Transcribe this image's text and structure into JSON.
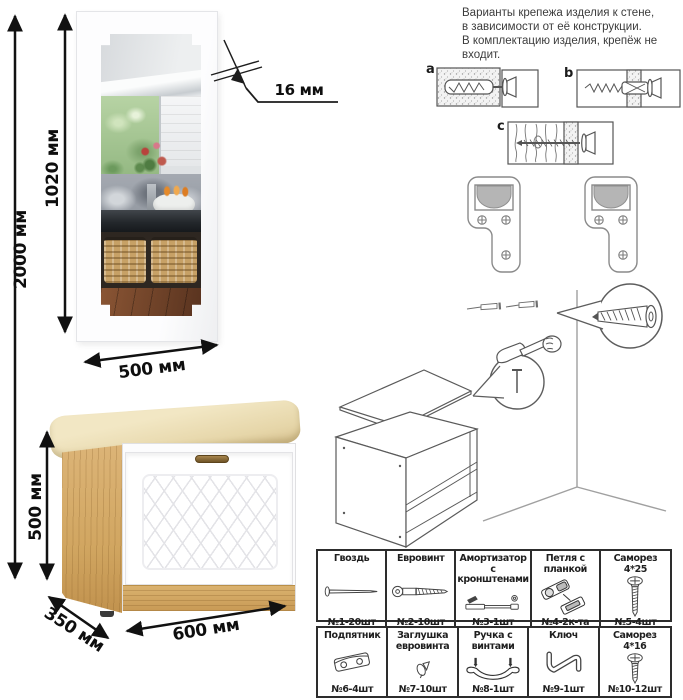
{
  "note": {
    "text": "Варианты крепежа изделия к стене,\nв зависимости от её конструкции.\nВ комплектацию изделия, крепёж не\nвходит."
  },
  "dimensions": {
    "total_height": "2000 мм",
    "mirror_height": "1020 мм",
    "mirror_width": "500 мм",
    "panel_thickness": "16 мм",
    "cabinet_height": "500 мм",
    "cabinet_depth": "350 мм",
    "cabinet_width": "600 мм"
  },
  "wall_mount_options": {
    "a": "a",
    "b": "b",
    "c": "c"
  },
  "hardware_table": {
    "items": [
      {
        "name": "Гвоздь",
        "count": "№1-20шт"
      },
      {
        "name": "Евровинт",
        "count": "№2-10шт"
      },
      {
        "name": "Амортизатор с кронштенами",
        "count": "№3-1шт"
      },
      {
        "name": "Петля с планкой",
        "count": "№4-2к-та"
      },
      {
        "name": "Саморез 4*25",
        "count": "№5-4шт"
      },
      {
        "name": "Подпятник",
        "count": "№6-4шт"
      },
      {
        "name": "Заглушка евровинта",
        "count": "№7-10шт"
      },
      {
        "name": "Ручка с винтами",
        "count": "№8-1шт"
      },
      {
        "name": "Ключ",
        "count": "№9-1шт"
      },
      {
        "name": "Саморез 4*16",
        "count": "№10-12шт"
      }
    ]
  },
  "colors": {
    "oak": "#d5ab67",
    "cushion": "#ecdfb6",
    "door": "#ffffff",
    "dimension_line": "#111111"
  }
}
